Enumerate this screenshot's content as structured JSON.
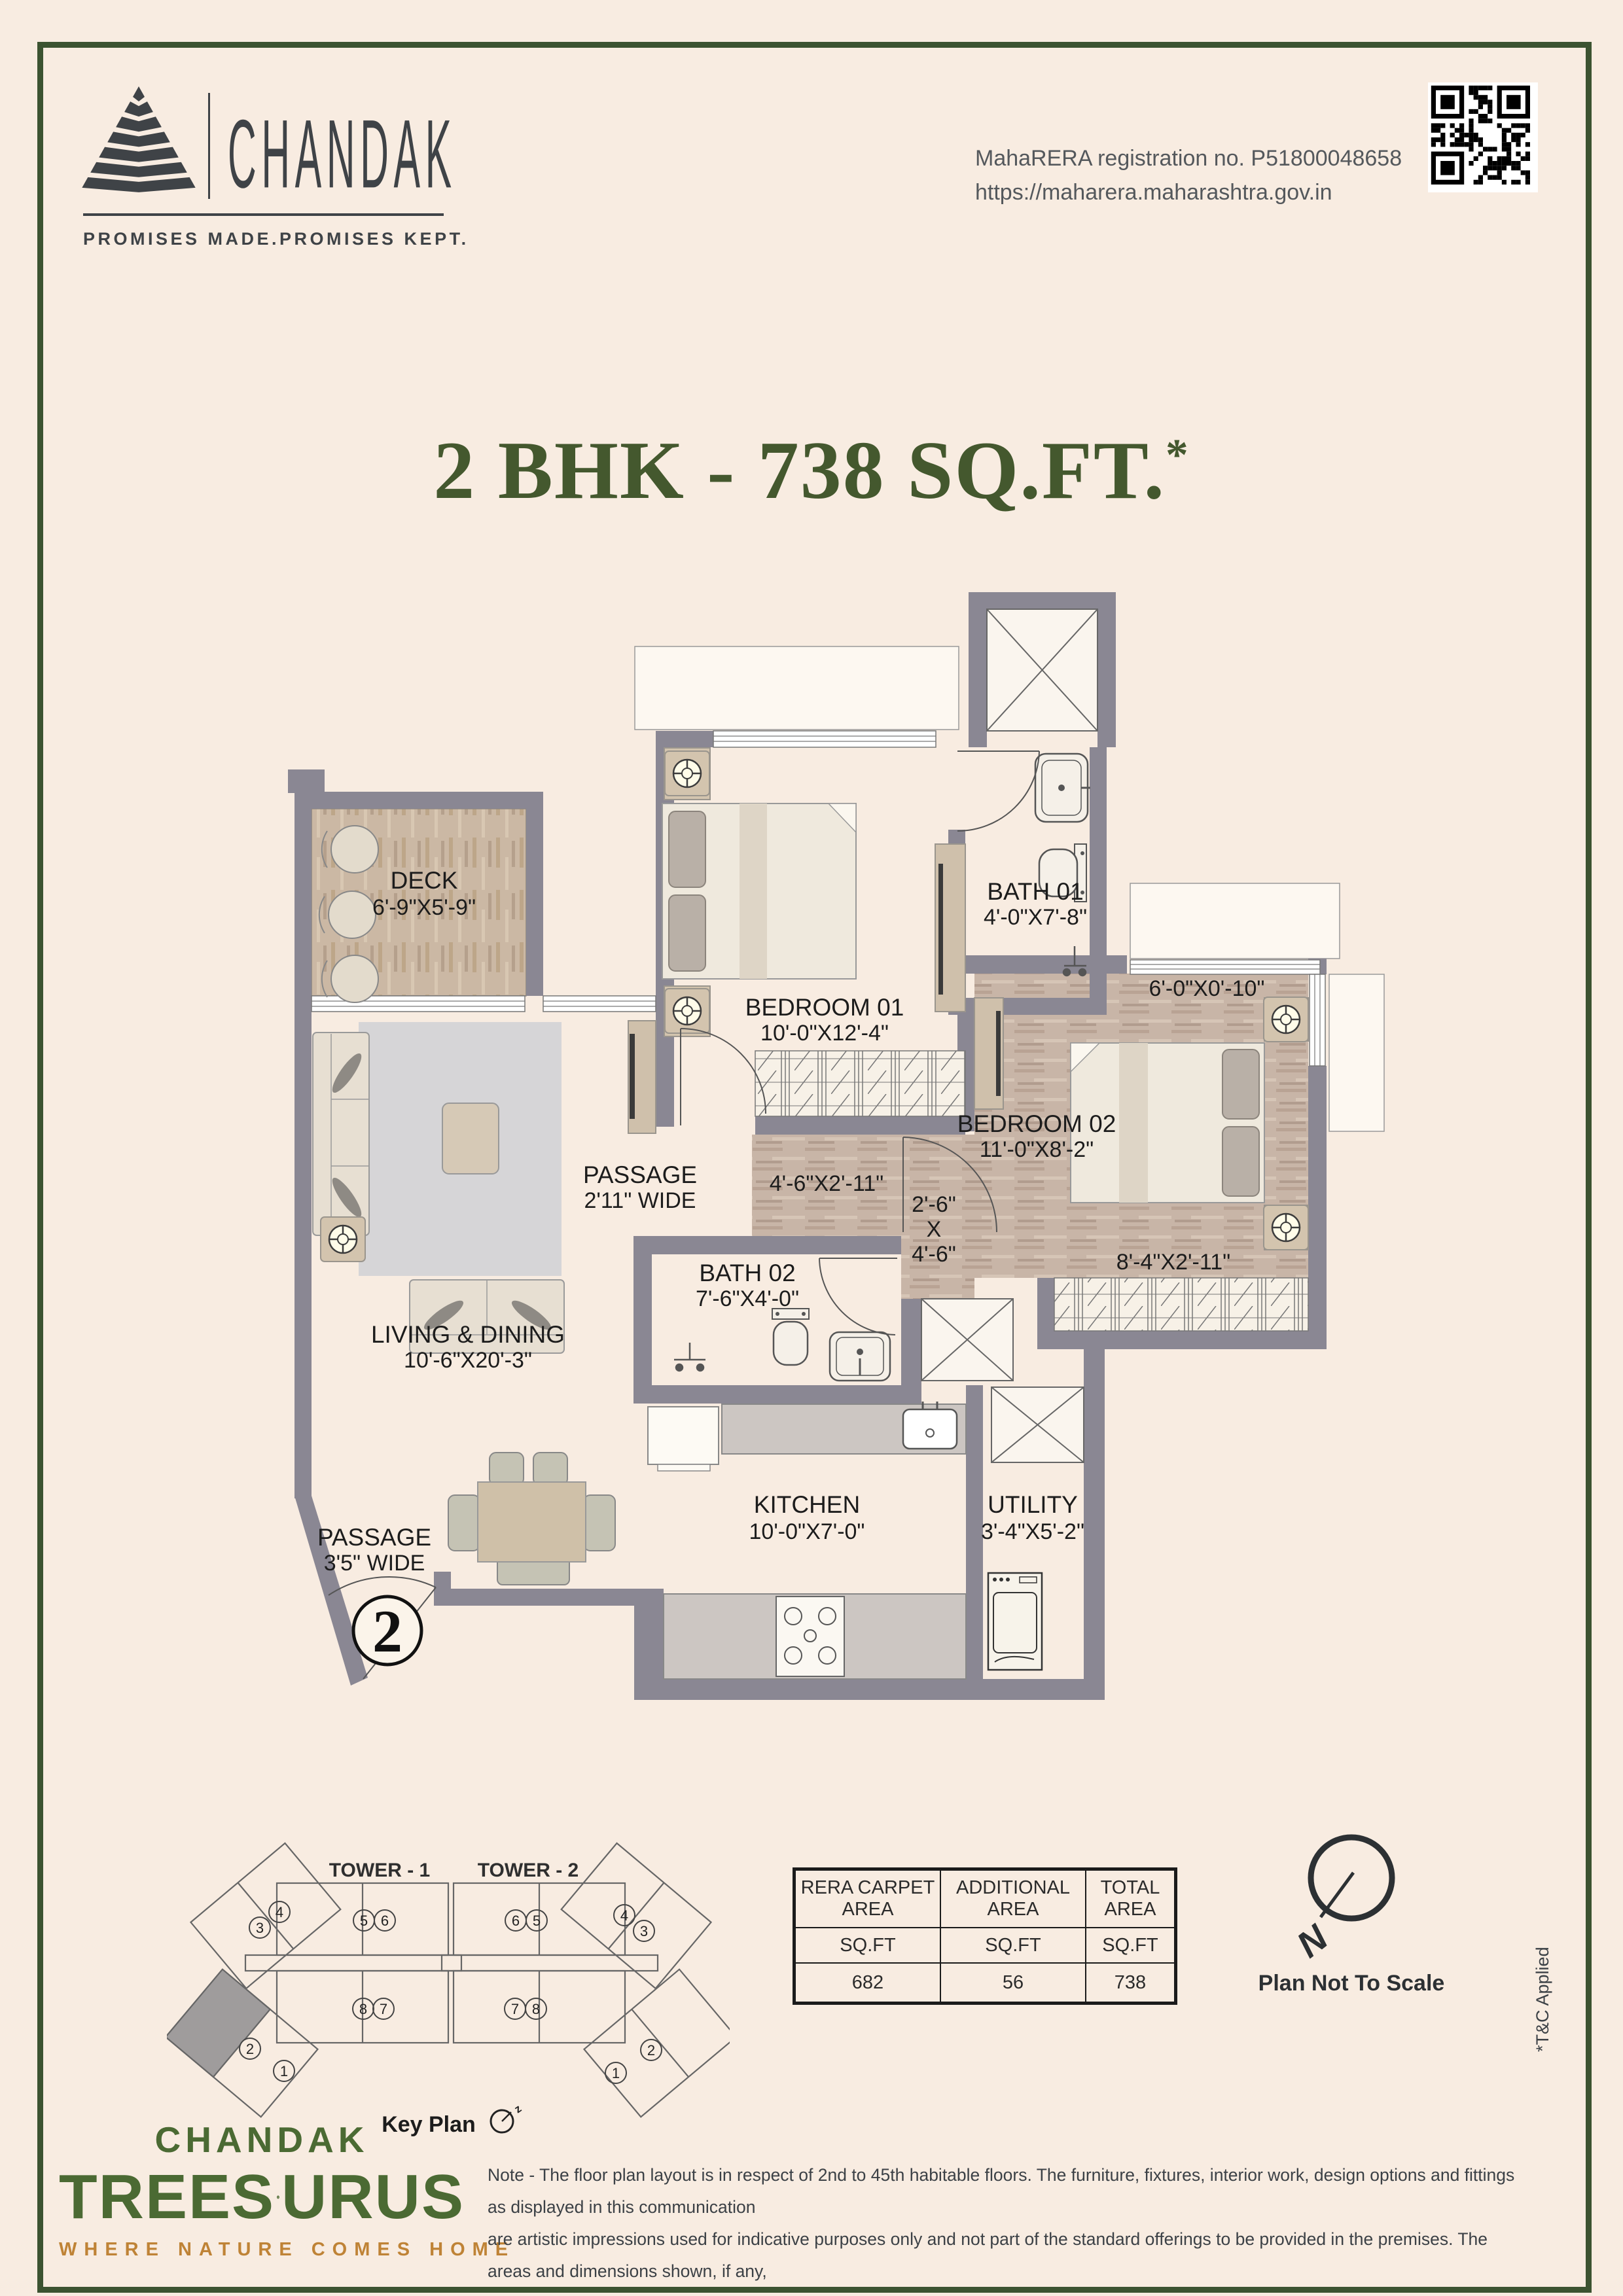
{
  "header": {
    "brand": "CHANDAK",
    "tagline": "PROMISES MADE.PROMISES KEPT.",
    "rera_line1": "MahaRERA registration no. P51800048658",
    "rera_line2": "https://maharera.maharashtra.gov.in"
  },
  "title": {
    "text": "2 BHK - 738 SQ.FT.",
    "asterisk": "*"
  },
  "floor_plan": {
    "rooms": {
      "deck": {
        "name": "DECK",
        "dims": "6'-9\"X5'-9\""
      },
      "bedroom01": {
        "name": "BEDROOM 01",
        "dims": "10'-0\"X12'-4\""
      },
      "bath01": {
        "name": "BATH 01",
        "dims": "4'-0\"X7'-8\""
      },
      "bedroom02": {
        "name": "BEDROOM 02",
        "dims": "11'-0\"X8'-2\""
      },
      "bath02": {
        "name": "BATH 02",
        "dims": "7'-6\"X4'-0\""
      },
      "living": {
        "name": "LIVING & DINING",
        "dims": "10'-6\"X20'-3\""
      },
      "kitchen": {
        "name": "KITCHEN",
        "dims": "10'-0\"X7'-0\""
      },
      "utility": {
        "name": "UTILITY",
        "dims": "3'-4\"X5'-2\""
      },
      "passage1": {
        "name": "PASSAGE",
        "dims": "2'11\" WIDE"
      },
      "passage2": {
        "name": "PASSAGE",
        "dims": "3'5\" WIDE"
      }
    },
    "extra_dims": {
      "bed02_top": "6'-0\"X0'-10\"",
      "bed02_bottom": "8'-4\"X2'-11\"",
      "passage_a": "4'-6\"X2'-11\"",
      "passage_b1": "2'-6\"",
      "passage_b2": "X",
      "passage_b3": "4'-6\""
    },
    "entrance_number": "2"
  },
  "key_plan": {
    "tower1_label": "TOWER - 1",
    "tower2_label": "TOWER - 2",
    "key_label": "Key Plan",
    "tower1_units": [
      "3",
      "4",
      "5",
      "6",
      "8",
      "7",
      "2",
      "1"
    ],
    "tower2_units": [
      "6",
      "5",
      "7",
      "8",
      "4",
      "3",
      "1",
      "2"
    ]
  },
  "area_table": {
    "headers": [
      "RERA CARPET AREA",
      "ADDITIONAL AREA",
      "TOTAL AREA"
    ],
    "unit_row": [
      "SQ.FT",
      "SQ.FT",
      "SQ.FT"
    ],
    "values": [
      "682",
      "56",
      "738"
    ]
  },
  "compass": {
    "north": "N",
    "note": "Plan Not To Scale"
  },
  "tnc": "*T&C Applied",
  "footer": {
    "brand": "CHANDAK",
    "treesourus_left": "TREES",
    "treesourus_right": "URUS",
    "tagline": "WHERE NATURE COMES HOME",
    "note_lines": [
      "Note - The floor plan layout is in respect of 2nd to 45th habitable floors. The furniture, fixtures, interior work, design options and fittings as displayed in this communication",
      "are artistic impressions used for indicative purposes only and not part of the standard offerings to be provided in the premises. The areas and dimensions shown, if any,",
      "are as per the plans approved by the concerned authority and the same are subject to construction exigencies and variations. Intending purchasers are requested to",
      "verify all the details before acting in any manner with respect to the project. Project financed by ICICI Bank Limited."
    ]
  },
  "colors": {
    "background": "#f8ece1",
    "frame_green": "#3c5331",
    "title_green": "#44582e",
    "wall_gray": "#8a8793",
    "brand_green": "#4b6a33",
    "accent_orange": "#bf8336"
  }
}
